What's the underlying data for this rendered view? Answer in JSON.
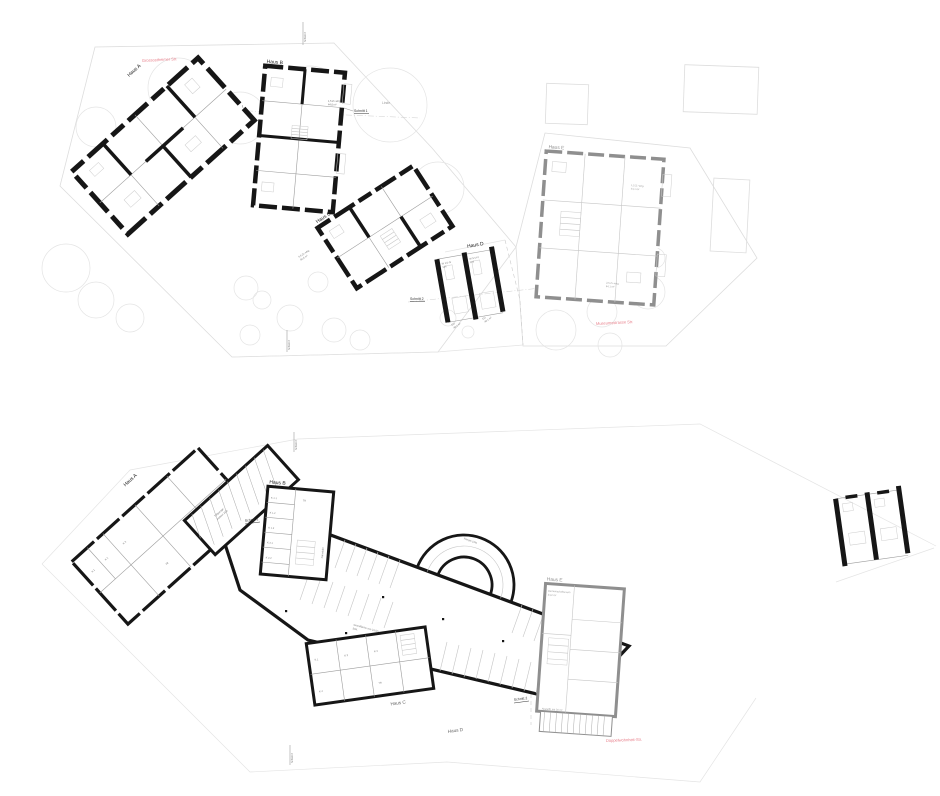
{
  "sheet": {
    "bg": "#ffffff"
  },
  "colors": {
    "wall": "#161616",
    "gray_wall": "#8f8f8f",
    "street_red": "#e8808c"
  },
  "upper": {
    "haus_a": "Haus A",
    "haus_b": "Haus B",
    "haus_c": "Haus C",
    "haus_d": "Haus D",
    "haus_e": "Haus E",
    "street_nw": "Grossostheimer Str.",
    "street_se": "Museumsstrasse Str.",
    "linde": "Linde",
    "schnitt1_left": "Schnitt 1",
    "schnitt1_right": "Schnitt 1",
    "schnitt2": "Schnitt 2",
    "schnitt3_top": "Schnitt 3",
    "schnitt3_bottom": "Schnitt 3",
    "flat_b_1": "1,5 Zi.-whg.",
    "flat_b_2": "44,6 m²",
    "flat_c_1": "3,5 Zi.-whg.",
    "flat_c_2": "84,6 m²",
    "flat_e1_1": "1,5 Zi.-whg.",
    "flat_e1_2": "44,1 m²",
    "flat_e2_1": "2,5 Zi.-whg.",
    "flat_e2_2": "64,1 m²",
    "d_code_left": "W 1/1-IV",
    "d_code_left2": "124",
    "d_code_right": "W 1/1-IV",
    "d_code_right2": "124",
    "d_eg_left_1": "EG",
    "d_eg_left_2": "46,1 m²",
    "d_eg_right_1": "EG",
    "d_eg_right_2": "46,1 m²"
  },
  "lower": {
    "haus_a": "Haus A",
    "haus_b": "Haus B",
    "haus_c": "Haus C",
    "haus_d": "Haus D",
    "haus_e": "Haus E",
    "schnitt1": "Schnitt 1",
    "schnitt2": "Schnitt 2",
    "schnitt3_top": "Schnitt 3",
    "schnitt3_bottom": "Schnitt 3",
    "ramp": "Rampe 10%",
    "abfahrt_1": "Tiefgarage",
    "abfahrt_2": "Abfahrt 15%",
    "garage_1": "Grundfläche von 34,0m",
    "garage_2": "StPl.",
    "street_se": "Doppelwohnheit-Str.",
    "b_k11": "K 1.1",
    "b_k12": "K 1.2",
    "b_k13": "K 1.3",
    "b_k21": "K 2.1",
    "b_k22": "K 2.2",
    "b_tr": "TR",
    "b_side": "Fahrräder",
    "a_k1": "K 1",
    "a_k2": "K 2",
    "a_k3": "K 3",
    "a_tr": "TR",
    "c_k1": "K 1",
    "c_k2": "K 2",
    "c_k3": "K 3",
    "c_k4": "K 4",
    "c_tr": "TR",
    "e_room_1": "Gemeinschaftsraum",
    "e_room_2": "34,2 m²",
    "e_note": "Abstellfl. mit 30 m²"
  }
}
